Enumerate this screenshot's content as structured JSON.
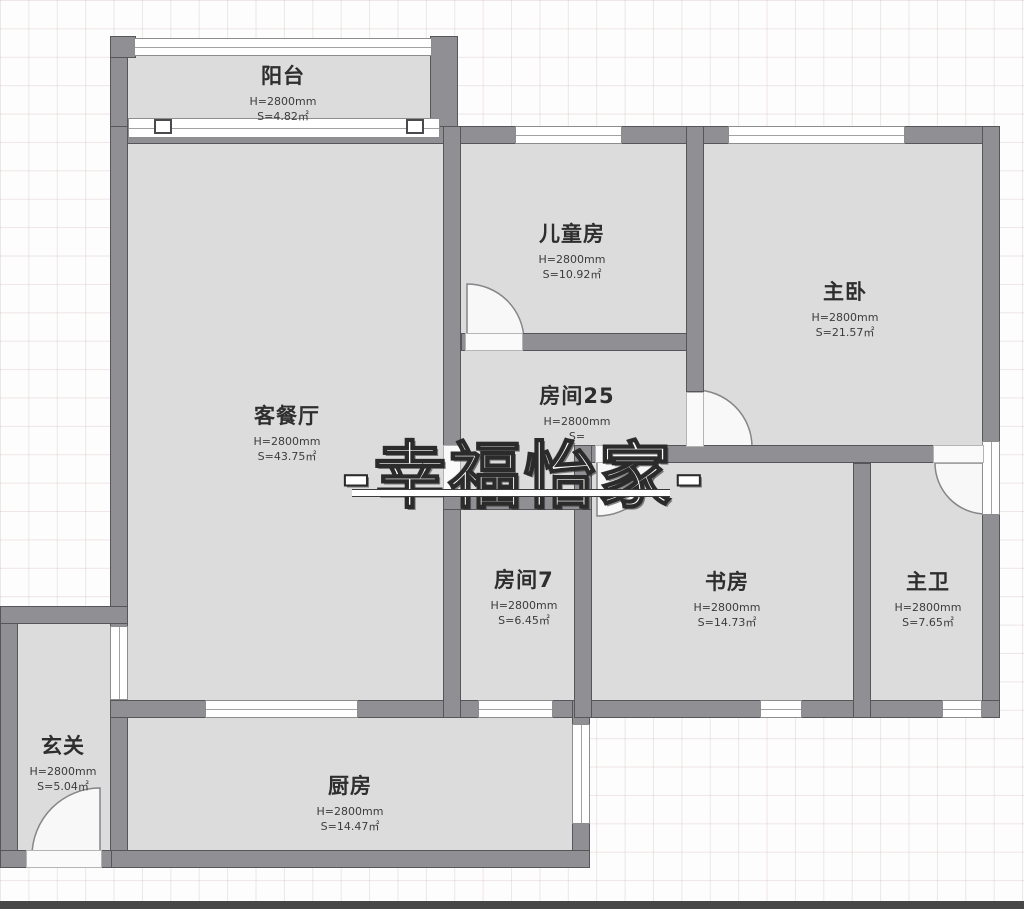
{
  "watermark": {
    "text": "-幸福怡家-"
  },
  "rooms": [
    {
      "name": "阳台",
      "height": "H=2800mm",
      "area": "S=4.82㎡"
    },
    {
      "name": "客餐厅",
      "height": "H=2800mm",
      "area": "S=43.75㎡"
    },
    {
      "name": "儿童房",
      "height": "H=2800mm",
      "area": "S=10.92㎡"
    },
    {
      "name": "主卧",
      "height": "H=2800mm",
      "area": "S=21.57㎡"
    },
    {
      "name": "房间25",
      "height": "H=2800mm",
      "area": "S="
    },
    {
      "name": "房间7",
      "height": "H=2800mm",
      "area": "S=6.45㎡"
    },
    {
      "name": "书房",
      "height": "H=2800mm",
      "area": "S=14.73㎡"
    },
    {
      "name": "主卫",
      "height": "H=2800mm",
      "area": "S=7.65㎡"
    },
    {
      "name": "玄关",
      "height": "H=2800mm",
      "area": "S=5.04㎡"
    },
    {
      "name": "厨房",
      "height": "H=2800mm",
      "area": "S=14.47㎡"
    }
  ],
  "colors": {
    "wall": "#8f8f94",
    "wall_edge": "#55555a",
    "floor": "#dcdcdc",
    "grid_line": "#e6d0d0",
    "watermark_fill": "#ffffff",
    "watermark_outline": "#2b2b2b"
  }
}
